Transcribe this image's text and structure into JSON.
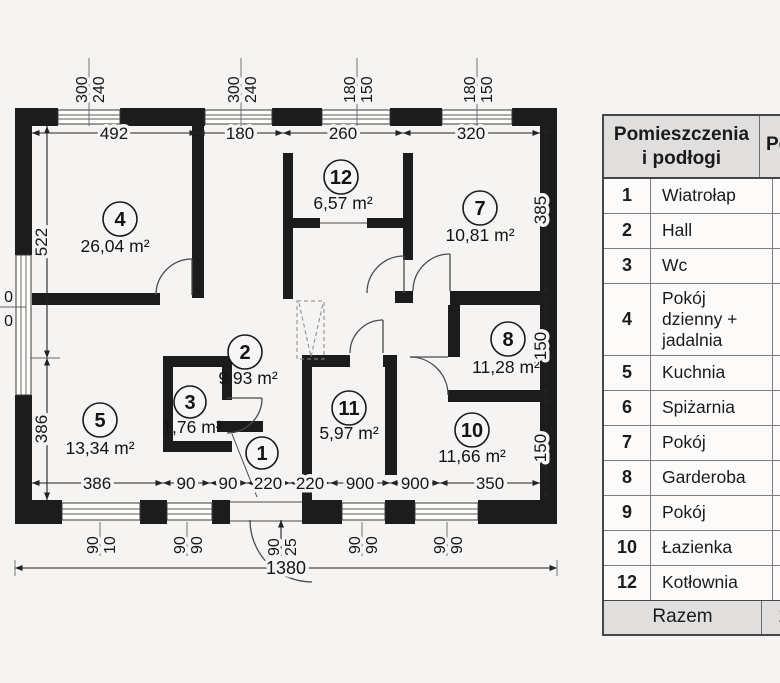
{
  "plan": {
    "rooms": [
      {
        "number": "1",
        "area": ""
      },
      {
        "number": "2",
        "area": "9,93 m²"
      },
      {
        "number": "3",
        "area": "1,76 m²"
      },
      {
        "number": "4",
        "area": "26,04 m²"
      },
      {
        "number": "5",
        "area": "13,34 m²"
      },
      {
        "number": "7",
        "area": "10,81 m²"
      },
      {
        "number": "8",
        "area": "11,28 m²"
      },
      {
        "number": "10",
        "area": "11,66 m²"
      },
      {
        "number": "11",
        "area": "5,97 m²"
      },
      {
        "number": "12",
        "area": "6,57 m²"
      }
    ],
    "dims": {
      "top": [
        "492",
        "180",
        "260",
        "320"
      ],
      "bottom": [
        "386",
        "90",
        "90",
        "220",
        "220",
        "900",
        "900",
        "350"
      ],
      "left": [
        "522",
        "386"
      ],
      "right": [
        "385",
        "150",
        "150"
      ],
      "total_width": "1380"
    },
    "windows": {
      "top": [
        {
          "w": "300",
          "h": "240"
        },
        {
          "w": "300",
          "h": "240"
        },
        {
          "w": "180",
          "h": "150"
        },
        {
          "w": "180",
          "h": "150"
        }
      ],
      "bottom": [
        {
          "w": "90",
          "h": "10"
        },
        {
          "w": "90",
          "h": "90"
        },
        {
          "w": "90",
          "h": "90"
        },
        {
          "w": "90",
          "h": "90"
        }
      ],
      "entry_door": {
        "w": "90",
        "h": "25"
      },
      "left_fragment": {
        "top": "0",
        "bottom": "0"
      }
    }
  },
  "table": {
    "header": {
      "title_line1": "Pomieszczenia",
      "title_line2": "i podłogi",
      "area_col_partial": "Po"
    },
    "rows": [
      {
        "no": "1",
        "name": "Wiatrołap"
      },
      {
        "no": "2",
        "name": "Hall"
      },
      {
        "no": "3",
        "name": "Wc"
      },
      {
        "no": "4",
        "name": "Pokój dzienny + jadalnia"
      },
      {
        "no": "5",
        "name": "Kuchnia"
      },
      {
        "no": "6",
        "name": "Spiżarnia"
      },
      {
        "no": "7",
        "name": "Pokój"
      },
      {
        "no": "8",
        "name": "Garderoba"
      },
      {
        "no": "9",
        "name": "Pokój"
      },
      {
        "no": "10",
        "name": "Łazienka"
      },
      {
        "no": "12",
        "name": "Kotłownia"
      }
    ],
    "footer": {
      "label": "Razem",
      "value_partial": "1"
    }
  }
}
